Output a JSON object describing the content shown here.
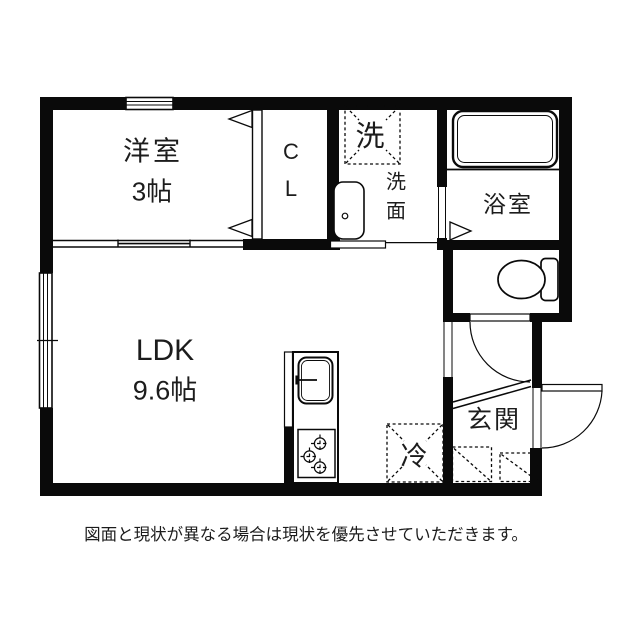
{
  "plan": {
    "rooms": {
      "western_room": {
        "name": "洋室",
        "size": "3帖"
      },
      "closet": {
        "letter1": "C",
        "letter2": "L"
      },
      "ldk": {
        "name": "LDK",
        "size": "9.6帖"
      },
      "washing_machine": {
        "label": "洗"
      },
      "washroom": {
        "label": "洗面"
      },
      "bathroom": {
        "label": "浴室"
      },
      "refrigerator": {
        "label": "冷"
      },
      "entrance": {
        "label": "玄関"
      }
    },
    "colors": {
      "wall": "#0a0a0a",
      "text": "#1c1c1c",
      "background": "#ffffff"
    }
  },
  "caption": "図面と現状が異なる場合は現状を優先させていただきます。"
}
